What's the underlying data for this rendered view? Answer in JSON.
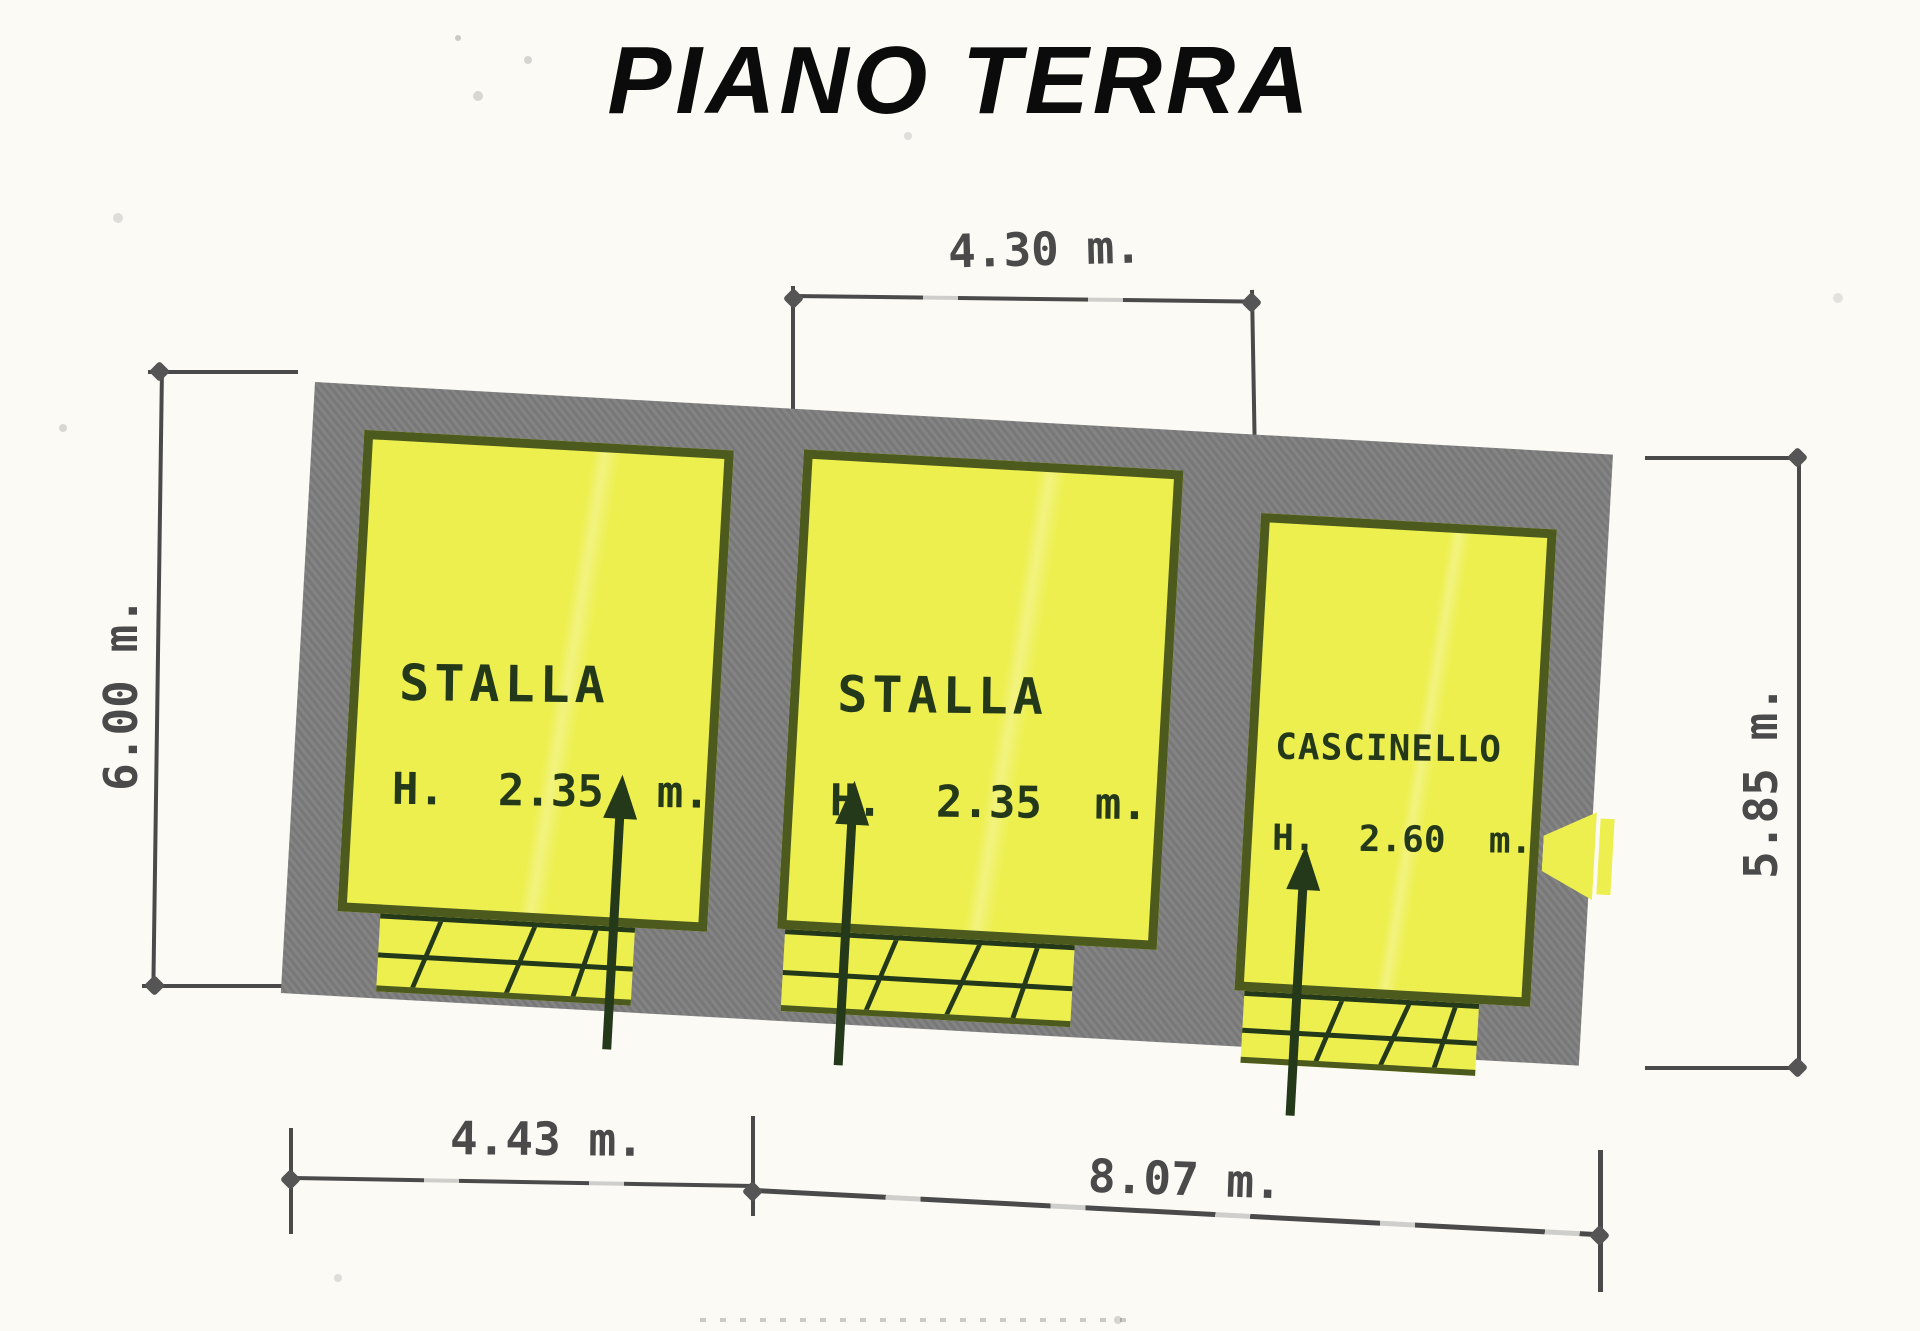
{
  "title": "PIANO TERRA",
  "dimensions": {
    "top_width": "4.30 m.",
    "left_height": "6.00 m.",
    "right_height": "5.85 m.",
    "bottom_left_width": "4.43 m.",
    "bottom_right_width": "8.07 m."
  },
  "rooms": [
    {
      "name": "STALLA",
      "height": "H.  2.35  m."
    },
    {
      "name": "STALLA",
      "height": "H.  2.35  m."
    },
    {
      "name": "CASCINELLO",
      "height": "H.  2.60  m."
    }
  ],
  "colors": {
    "paper": "#fbfaf5",
    "wall_gray": "#7d7d7d",
    "room_yellow": "#edef4f",
    "marker_green": "#4c5a1d",
    "ink_green": "#24381a",
    "dim_ink": "#4a4a4a",
    "title_ink": "#0b0b0b"
  }
}
